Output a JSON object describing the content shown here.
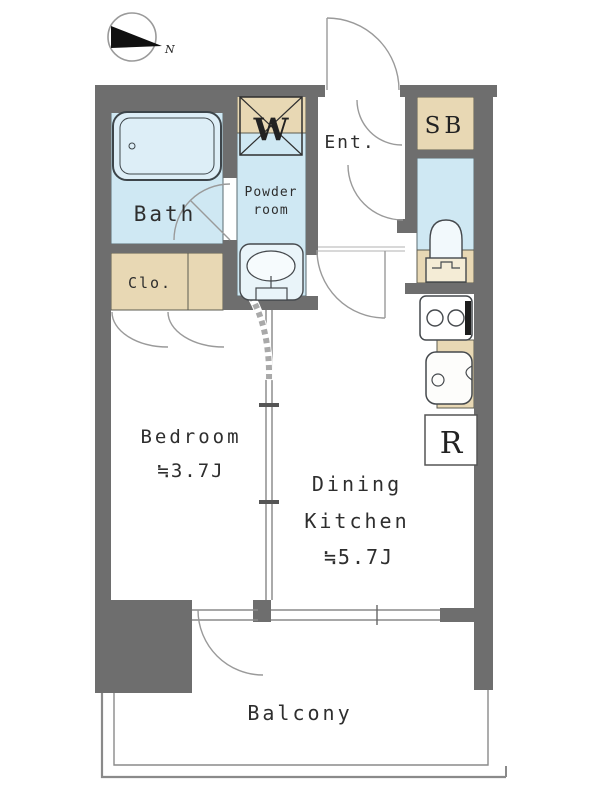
{
  "palette": {
    "wall": "#6e6e6e",
    "wet_area": "#cfe8f3",
    "storage": "#e8d8b4",
    "floor": "#ffffff",
    "outline": "#45494d",
    "door_line": "#9a9a9a"
  },
  "compass": {
    "direction_label": "N"
  },
  "rooms": {
    "bath": {
      "label": "Bath"
    },
    "powder": {
      "label_line1": "Powder",
      "label_line2": "room"
    },
    "washer": {
      "label": "W"
    },
    "entrance": {
      "label": "Ent."
    },
    "shoe_box": {
      "label": "SB"
    },
    "closet": {
      "label": "Clo."
    },
    "refrigerator": {
      "label": "R"
    },
    "bedroom": {
      "label": "Bedroom",
      "size": "≒3.7J"
    },
    "dining_kitchen": {
      "label_line1": "Dining",
      "label_line2": "Kitchen",
      "size": "≒5.7J"
    },
    "balcony": {
      "label": "Balcony"
    }
  },
  "fixtures": [
    "bathtub",
    "washing-machine-pan",
    "washbasin",
    "toilet",
    "stove",
    "kitchen-sink"
  ]
}
